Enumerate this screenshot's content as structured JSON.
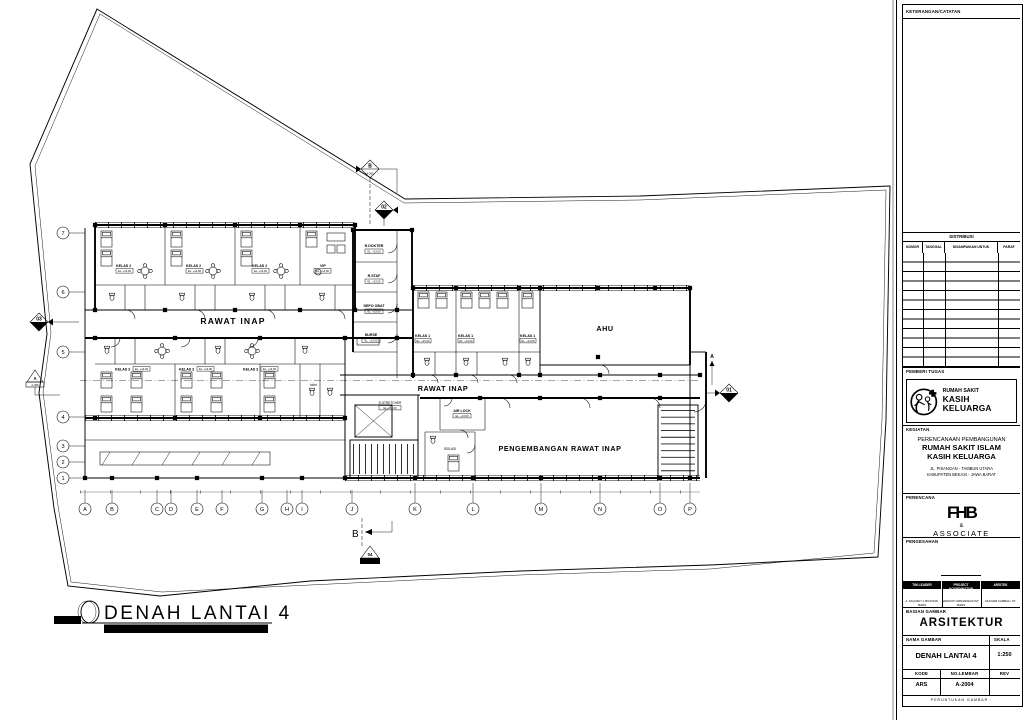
{
  "titleblock": {
    "keterangan": "KETERANGAN/CATATAN",
    "distribusi": "DISTRIBUSI",
    "table_headers": [
      "NOMOR",
      "TANGGAL",
      "DISAMPAIKAN UNTUK",
      "PARAF"
    ],
    "pemberi_tugas": "PEMBERI TUGAS",
    "logo_line1": "RUMAH SAKIT",
    "logo_line2": "KASIH KELUARGA",
    "kegiatan": "KEGIATAN",
    "project_line1": "PERENCANAAN PEMBANGUNAN",
    "project_line2": "RUMAH SAKIT ISLAM",
    "project_line3": "KASIH KELUARGA",
    "address_line1": "JL. PISANGAN - TAMBUN UTARA",
    "address_line2": "KABUPATEN BEKASI - JAWA BARAT",
    "perencana": "PERENCANA",
    "perencana_logo": "FHB",
    "perencana_amp": "&",
    "perencana_assoc": "ASSOCIATE",
    "pengesahan": "PENGESAHAN",
    "sign_headers": [
      "TIM LEADER",
      "PROJECT KOORDINATOR",
      "ARSITEK"
    ],
    "sign_names": [
      "A. FAQURY H. BUSTAMI, MARS",
      "HIDAYATI ARNANDHOLIST, MARS",
      "DHOHIM KAMBALI, ST"
    ],
    "bagian_gambar": "BAGIAN GAMBAR",
    "bagian_value": "ARSITEKTUR",
    "nama_gambar": "NAMA GAMBAR",
    "skala": "SKALA",
    "nama_value": "DENAH LANTAI 4",
    "skala_value": "1:250",
    "kode": "KODE",
    "no_lembar": "NO.LEMBAR",
    "rev": "REV",
    "kode_value": "ARS",
    "no_lembar_value": "A-2004",
    "peruntukan": "PERUNTUKAN GAMBAR :"
  },
  "drawing_title": {
    "scale_box": "Skala 1:250",
    "name": "DENAH LANTAI 4",
    "subtitle": "RS. KASIH KELUARGA - BEKASI UTARA"
  },
  "plan": {
    "rooms": {
      "kelas2": "KELAS 2",
      "vip": "VIP",
      "kelas3": "KELAS 3",
      "kelas1": "KELAS 1",
      "r_dokter": "R.DOKTER",
      "r_staf": "R.STAF",
      "depo_obat": "DEPO OBAT",
      "nurse": "NURSE",
      "ahu": "AHU",
      "rawat_inap": "RAWAT INAP",
      "pengembangan": "PENGEMBANGAN RAWAT INAP",
      "r_stretcher": "R.STRETCHER",
      "air_lock": "AIR LOCK",
      "isolasi": "ISOLASI",
      "toilet": "toilet",
      "elev_tag": "EL. +13.00"
    },
    "grid": {
      "letters": [
        "A",
        "B",
        "C",
        "D",
        "E",
        "F",
        "G",
        "H",
        "I",
        "J",
        "K",
        "L",
        "M",
        "N",
        "O",
        "P"
      ],
      "numbers": [
        "7",
        "6",
        "5",
        "4",
        "3",
        "2",
        "1"
      ]
    },
    "markers": {
      "top_b": {
        "label": "B",
        "sheet": "A-305"
      },
      "sec02": {
        "label": "02",
        "sheet": "A-300"
      },
      "sec03": {
        "label": "03",
        "sheet": "A-300"
      },
      "left_a": {
        "label": "A",
        "sheet": "A-305"
      },
      "sec01": {
        "label": "01",
        "sheet": "A-300"
      },
      "sec04": {
        "label": "04",
        "sheet": "A-300"
      },
      "bottom_b": "B",
      "right_a": "A"
    }
  }
}
